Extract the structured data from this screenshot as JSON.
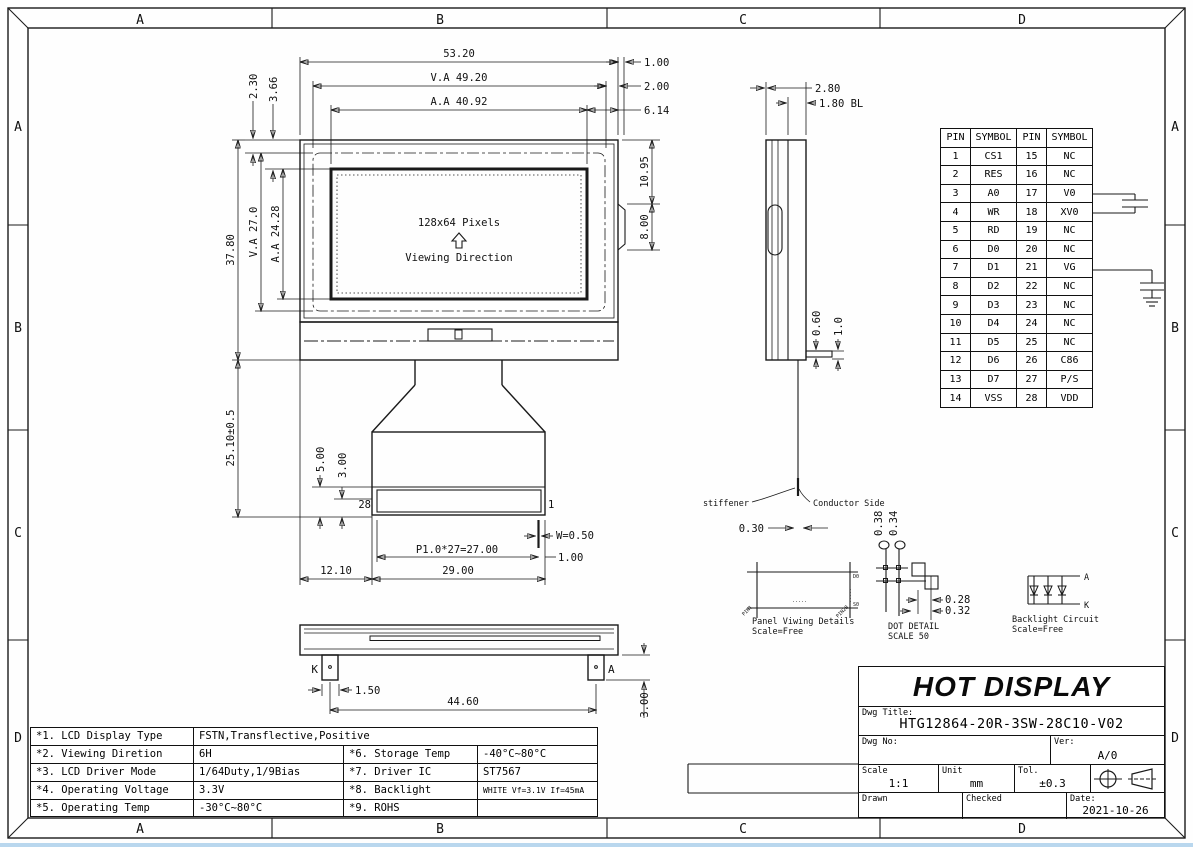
{
  "border": {
    "zones": [
      "A",
      "B",
      "C",
      "D"
    ]
  },
  "front_view": {
    "pixels_label": "128x64 Pixels",
    "viewing_direction_label": "Viewing Direction",
    "dim_width": "53.20",
    "dim_va_width": "V.A 49.20",
    "dim_aa_width": "A.A 40.92",
    "dim_right_1": "1.00",
    "dim_right_2": "2.00",
    "dim_right_3": "6.14",
    "dim_tab_offset": "10.95",
    "dim_tab_height": "8.00",
    "dim_top_left_1": "2.30",
    "dim_top_left_2": "3.66",
    "dim_height": "37.80",
    "dim_va_height": "V.A 27.0",
    "dim_aa_height": "A.A 24.28",
    "dim_fpc_length": "25.10±0.5"
  },
  "connector": {
    "pin_left": "28",
    "pin_right": "1",
    "dim_5": "5.00",
    "dim_3": "3.00",
    "dim_w": "W=0.50",
    "dim_pitch": "P1.0*27=27.00",
    "dim_1": "1.00",
    "dim_left": "12.10",
    "dim_total": "29.00"
  },
  "bottom_view": {
    "cathode": "K",
    "anode": "A",
    "dim_pin": "1.50",
    "dim_span": "44.60",
    "dim_pin_h": "3.00"
  },
  "side_view": {
    "dim_thickness": "2.80",
    "dim_bl": "1.80 BL",
    "dim_pin_t": "0.60",
    "dim_pin_w": "1.0",
    "stiffener_label": "stiffener",
    "conductor_label": "Conductor Side",
    "dim_fpc_t": "0.30"
  },
  "details": {
    "panel": {
      "title": "Panel Viwing Details",
      "scale": "Scale=Free",
      "tag_top": "D0",
      "tag_bottom": "S0",
      "tag_left": "PIN1",
      "tag_right": "PIN28",
      "dots": "....."
    },
    "dot": {
      "title": "DOT DETAIL",
      "scale": "SCALE 50",
      "dim_h1": "0.38",
      "dim_h2": "0.34",
      "dim_w1": "0.28",
      "dim_w2": "0.32"
    },
    "backlight": {
      "title": "Backlight Circuit",
      "scale": "Scale=Free",
      "anode": "A",
      "cathode": "K"
    }
  },
  "pin_table": {
    "headers": [
      "PIN",
      "SYMBOL",
      "PIN",
      "SYMBOL"
    ],
    "rows": [
      [
        "1",
        "CS1",
        "15",
        "NC"
      ],
      [
        "2",
        "RES",
        "16",
        "NC"
      ],
      [
        "3",
        "A0",
        "17",
        "V0"
      ],
      [
        "4",
        "WR",
        "18",
        "XV0"
      ],
      [
        "5",
        "RD",
        "19",
        "NC"
      ],
      [
        "6",
        "D0",
        "20",
        "NC"
      ],
      [
        "7",
        "D1",
        "21",
        "VG"
      ],
      [
        "8",
        "D2",
        "22",
        "NC"
      ],
      [
        "9",
        "D3",
        "23",
        "NC"
      ],
      [
        "10",
        "D4",
        "24",
        "NC"
      ],
      [
        "11",
        "D5",
        "25",
        "NC"
      ],
      [
        "12",
        "D6",
        "26",
        "C86"
      ],
      [
        "13",
        "D7",
        "27",
        "P/S"
      ],
      [
        "14",
        "VSS",
        "28",
        "VDD"
      ]
    ]
  },
  "spec_table": {
    "rows": [
      [
        "*1. LCD Display Type",
        "FSTN,Transflective,Positive"
      ],
      [
        "*2. Viewing Diretion",
        "6H",
        "*6. Storage Temp",
        "-40°C~80°C"
      ],
      [
        "*3. LCD Driver Mode",
        "1/64Duty,1/9Bias",
        "*7. Driver IC",
        "ST7567"
      ],
      [
        "*4. Operating Voltage",
        "3.3V",
        "*8. Backlight",
        "WHITE Vf=3.1V If=45mA"
      ],
      [
        "*5. Operating Temp",
        "-30°C~80°C",
        "*9. ROHS",
        ""
      ]
    ]
  },
  "title_block": {
    "company": "HOT DISPLAY",
    "dwg_title_label": "Dwg Title:",
    "dwg_title": "HTG12864-20R-3SW-28C10-V02",
    "dwg_no_label": "Dwg No:",
    "ver_label": "Ver:",
    "ver_value": "A/0",
    "scale_label": "Scale",
    "scale_value": "1:1",
    "unit_label": "Unit",
    "unit_value": "mm",
    "tol_label": "Tol.",
    "tol_value": "±0.3",
    "drawn_label": "Drawn",
    "checked_label": "Checked",
    "date_label": "Date:",
    "date_value": "2021-10-26"
  }
}
